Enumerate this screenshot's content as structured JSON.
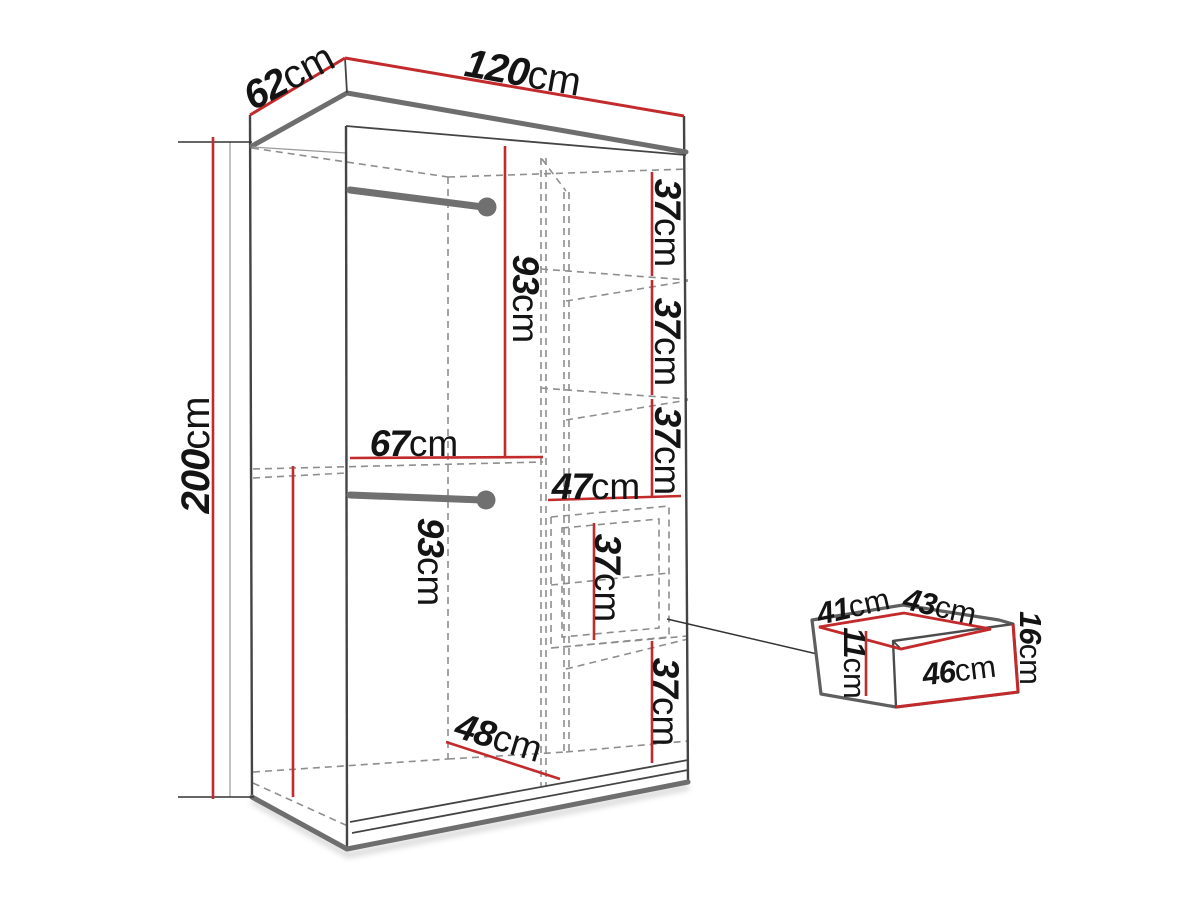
{
  "diagram": {
    "type": "furniture-dimension-diagram",
    "subject": "two-door sliding wardrobe with hanging rods, shelf column and drawer",
    "wardrobe": {
      "width": {
        "value": "120",
        "unit": "cm"
      },
      "depth": {
        "value": "62",
        "unit": "cm"
      },
      "height": {
        "value": "200",
        "unit": "cm"
      },
      "upper_hanging": {
        "value": "93",
        "unit": "cm"
      },
      "left_width": {
        "value": "67",
        "unit": "cm"
      },
      "lower_hanging": {
        "value": "93",
        "unit": "cm"
      },
      "shelf_width": {
        "value": "47",
        "unit": "cm"
      },
      "shelves": [
        {
          "value": "37",
          "unit": "cm"
        },
        {
          "value": "37",
          "unit": "cm"
        },
        {
          "value": "37",
          "unit": "cm"
        }
      ],
      "drawer_bay": {
        "value": "37",
        "unit": "cm"
      },
      "bottom_shelf": {
        "value": "37",
        "unit": "cm"
      },
      "interior_depth": {
        "value": "48",
        "unit": "cm"
      }
    },
    "drawer": {
      "inner_width": {
        "value": "41",
        "unit": "cm"
      },
      "top_depth": {
        "value": "43",
        "unit": "cm"
      },
      "front_height": {
        "value": "16",
        "unit": "cm"
      },
      "front_width": {
        "value": "46",
        "unit": "cm"
      },
      "inner_depth": {
        "value": "11",
        "unit": "cm"
      }
    }
  },
  "colors": {
    "background": "#ffffff",
    "dimension_red": "#c22a2c",
    "outline_dark": "#444444",
    "edge_gray": "#6e6e6e",
    "dashed_gray": "#8e8e8e",
    "rod_gray": "#707070",
    "label_black": "#141414",
    "shadow": "#c2c2c2"
  }
}
